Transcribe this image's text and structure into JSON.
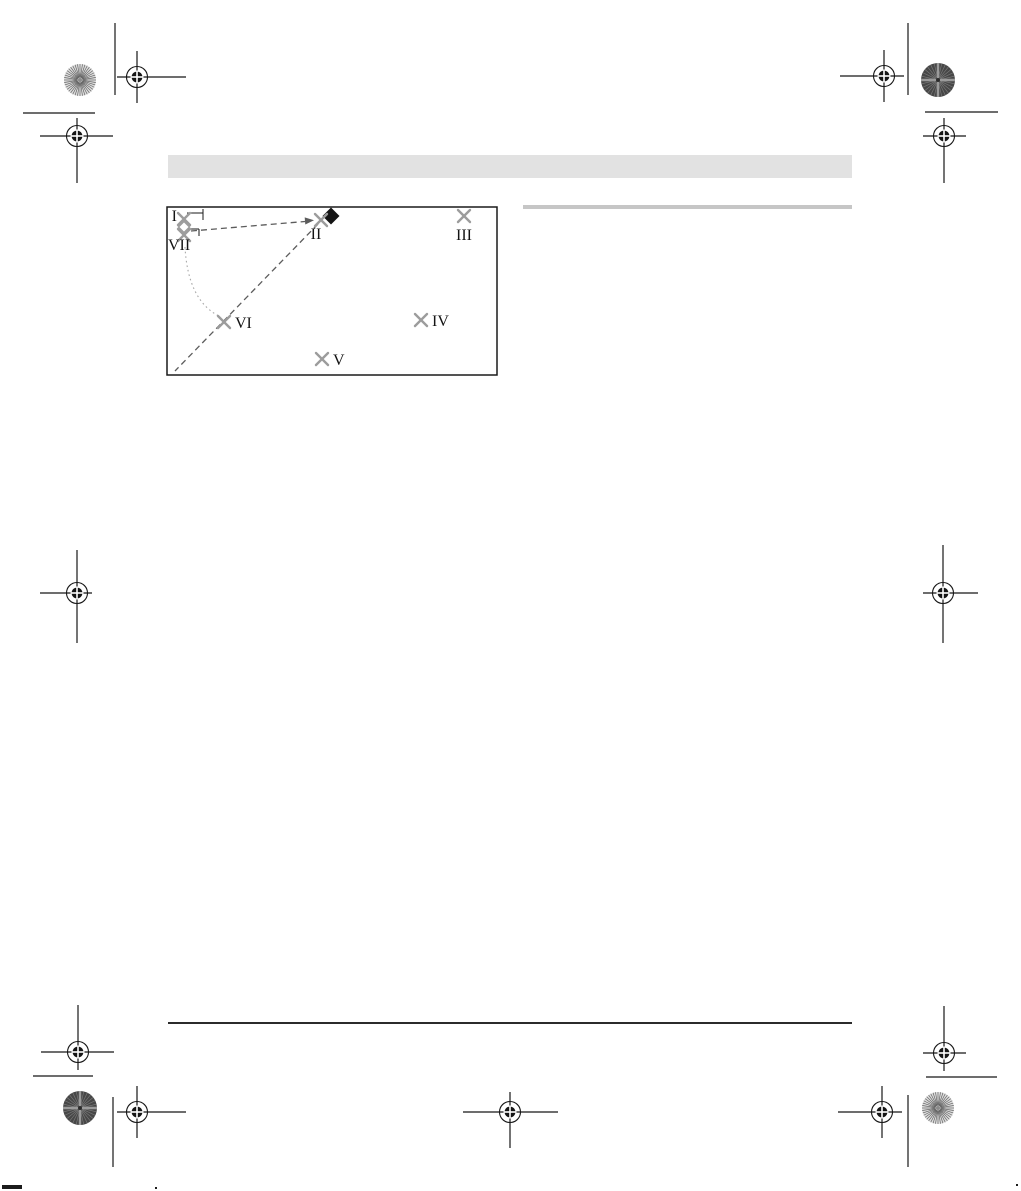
{
  "page": {
    "width": 1021,
    "height": 1191,
    "background": "#ffffff"
  },
  "header_bar": {
    "color": "#e2e2e2"
  },
  "section_rule": {
    "color": "#c6c6c6"
  },
  "footer_rule": {
    "color": "#2b2b2b"
  },
  "diagram": {
    "box": {
      "x": 167,
      "y": 207,
      "w": 330,
      "h": 168
    },
    "border_color": "#1a1a1a",
    "marker_color": "#9c9c9c",
    "label_color": "#141414",
    "dash_color": "#5c5c5c",
    "dot_color": "#a8a8a8",
    "points": [
      {
        "id": "I",
        "label": "I",
        "x": 184,
        "y": 219,
        "label_x": 177,
        "label_y": 221,
        "anchor": "end"
      },
      {
        "id": "II",
        "label": "II",
        "x": 321,
        "y": 220,
        "label_x": 316,
        "label_y": 239,
        "anchor": "middle"
      },
      {
        "id": "III",
        "label": "III",
        "x": 464,
        "y": 216,
        "label_x": 464,
        "label_y": 240,
        "anchor": "middle"
      },
      {
        "id": "IV",
        "label": "IV",
        "x": 421,
        "y": 320,
        "label_x": 432,
        "label_y": 326,
        "anchor": "start"
      },
      {
        "id": "V",
        "label": "V",
        "x": 322,
        "y": 359,
        "label_x": 333,
        "label_y": 365,
        "anchor": "start"
      },
      {
        "id": "VI",
        "label": "VI",
        "x": 224,
        "y": 322,
        "label_x": 235,
        "label_y": 328,
        "anchor": "start"
      },
      {
        "id": "VII",
        "label": "VII",
        "x": 184,
        "y": 235,
        "label_x": 168,
        "label_y": 250,
        "anchor": "start"
      }
    ],
    "dashed_lines": [
      {
        "x1": 191,
        "y1": 231,
        "x2": 305,
        "y2": 221.5
      },
      {
        "x1": 318,
        "y1": 224,
        "x2": 175,
        "y2": 371
      }
    ],
    "arrow": [
      [
        314.0,
        220.3
      ],
      [
        305.3,
        224.5
      ],
      [
        304.7,
        217.4
      ]
    ],
    "dotted_curve": {
      "path": "M 185 247 Q 188 302 221 317"
    },
    "brackets": [
      {
        "h": [
          187,
          213,
          203,
          213
        ],
        "tick": [
          203,
          209,
          203,
          220
        ]
      },
      {
        "h": [
          188,
          229,
          199,
          229
        ],
        "tick": [
          199,
          229,
          199,
          236
        ]
      }
    ],
    "open_diamond": {
      "x": 184,
      "y": 227,
      "r": 5.5
    },
    "filled_diamond": {
      "x": 331,
      "y": 216,
      "r": 8.5
    }
  },
  "printer_marks": {
    "ink": "#161616",
    "registration": [
      {
        "x": 137,
        "y": 77,
        "l": 20,
        "r": 49,
        "u": 26,
        "d": 26
      },
      {
        "x": 77,
        "y": 136,
        "l": 37,
        "r": 36,
        "u": 18,
        "d": 47
      },
      {
        "x": 884,
        "y": 76,
        "l": 44,
        "r": 20,
        "u": 26,
        "d": 26
      },
      {
        "x": 944,
        "y": 136,
        "l": 21,
        "r": 22,
        "u": 18,
        "d": 47
      },
      {
        "x": 77,
        "y": 593,
        "l": 37,
        "r": 15,
        "u": 43,
        "d": 50
      },
      {
        "x": 943,
        "y": 593,
        "l": 20,
        "r": 35,
        "u": 48,
        "d": 50
      },
      {
        "x": 78,
        "y": 1052,
        "l": 37,
        "r": 36,
        "u": 47,
        "d": 18
      },
      {
        "x": 137,
        "y": 1112,
        "l": 20,
        "r": 49,
        "u": 26,
        "d": 26
      },
      {
        "x": 510,
        "y": 1112,
        "l": 47,
        "r": 48,
        "u": 20,
        "d": 36
      },
      {
        "x": 944,
        "y": 1053,
        "l": 21,
        "r": 22,
        "u": 47,
        "d": 18
      },
      {
        "x": 882,
        "y": 1112,
        "l": 44,
        "r": 20,
        "u": 26,
        "d": 26
      }
    ],
    "crop_lines": [
      {
        "x1": 115,
        "y1": 23,
        "x2": 115,
        "y2": 95
      },
      {
        "x1": 23,
        "y1": 113,
        "x2": 95,
        "y2": 113
      },
      {
        "x1": 908,
        "y1": 23,
        "x2": 908,
        "y2": 95
      },
      {
        "x1": 925,
        "y1": 112,
        "x2": 998,
        "y2": 112
      },
      {
        "x1": 113,
        "y1": 1097,
        "x2": 113,
        "y2": 1167
      },
      {
        "x1": 33,
        "y1": 1076,
        "x2": 93,
        "y2": 1076
      },
      {
        "x1": 908,
        "y1": 1095,
        "x2": 908,
        "y2": 1167
      },
      {
        "x1": 926,
        "y1": 1077,
        "x2": 997,
        "y2": 1077
      }
    ],
    "wheels": [
      {
        "x": 80,
        "y": 80,
        "r": 16,
        "variant": "light"
      },
      {
        "x": 938,
        "y": 80,
        "r": 17,
        "variant": "dark"
      },
      {
        "x": 80,
        "y": 1108,
        "r": 17,
        "variant": "dark"
      },
      {
        "x": 938,
        "y": 1108,
        "r": 16,
        "variant": "light"
      }
    ],
    "artifacts": [
      {
        "x": 2,
        "y": 1185,
        "w": 20,
        "h": 4
      },
      {
        "x": 155,
        "y": 1187,
        "w": 2,
        "h": 2
      },
      {
        "x": 1016,
        "y": 1184,
        "w": 2,
        "h": 2
      }
    ]
  }
}
